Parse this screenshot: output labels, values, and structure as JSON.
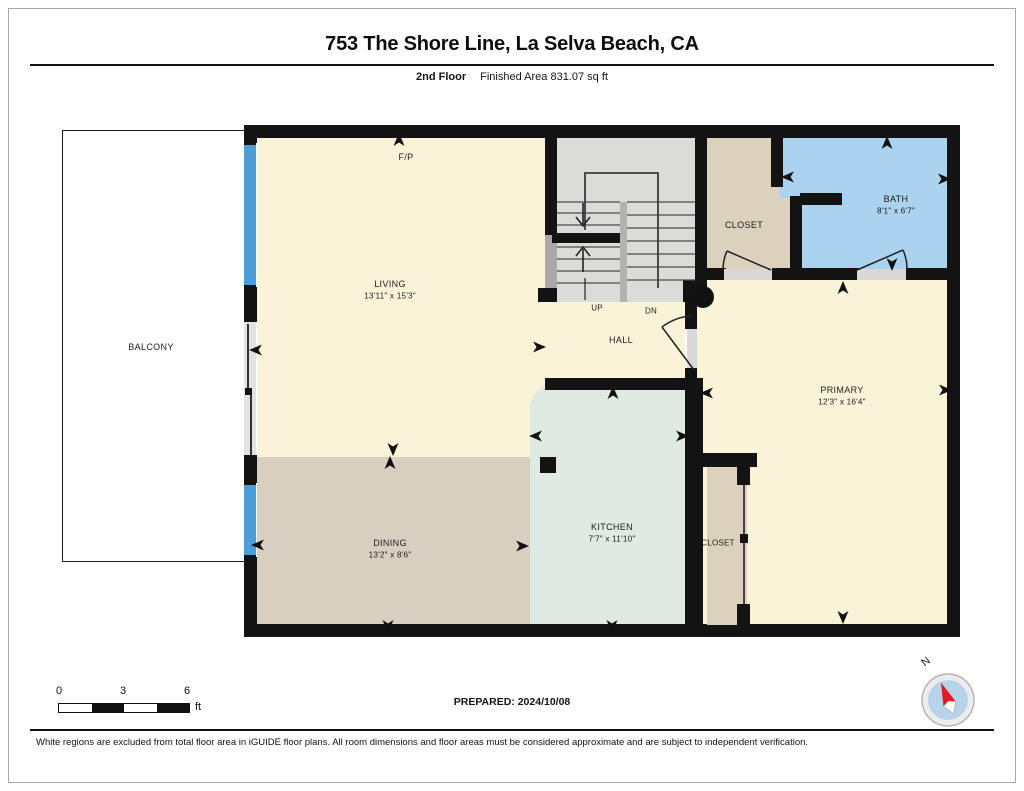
{
  "header": {
    "title": "753 The Shore Line, La Selva Beach, CA",
    "floor_label": "2nd Floor",
    "area_label": "Finished Area 831.07 sq ft"
  },
  "rooms": {
    "balcony": {
      "name": "BALCONY"
    },
    "living": {
      "name": "LIVING",
      "dims": "13'11\" x 15'3\""
    },
    "dining": {
      "name": "DINING",
      "dims": "13'2\" x 8'6\""
    },
    "kitchen": {
      "name": "KITCHEN",
      "dims": "7'7\" x 11'10\""
    },
    "primary": {
      "name": "PRIMARY",
      "dims": "12'3\" x 16'4\""
    },
    "bath": {
      "name": "BATH",
      "dims": "8'1\" x 6'7\""
    },
    "closet_top": {
      "name": "CLOSET"
    },
    "closet_primary": {
      "name": "CLOSET"
    },
    "hall": {
      "name": "HALL"
    },
    "fireplace": {
      "name": "F/P"
    },
    "stairs_up": {
      "name": "UP"
    },
    "stairs_down": {
      "name": "DN"
    }
  },
  "scale_bar": {
    "tick_0": "0",
    "tick_3": "3",
    "tick_6": "6",
    "unit": "ft"
  },
  "compass": {
    "north_label": "N"
  },
  "footer": {
    "prepared": "PREPARED: 2024/10/08",
    "disclaimer": "White regions are excluded from total floor area in iGUIDE floor plans. All room dimensions and floor areas must be considered approximate and are subject to independent verification."
  },
  "colors": {
    "floor_cream": "#FAF3D8",
    "floor_tan": "#D9CFC1",
    "closet_tan": "#DCD1BD",
    "floor_mint": "#DFEAE3",
    "bath_blue": "#A9D3EE",
    "window_blue": "#4A9ED9",
    "stair_gray": "#DBDBDA",
    "wall_black": "#131313"
  }
}
